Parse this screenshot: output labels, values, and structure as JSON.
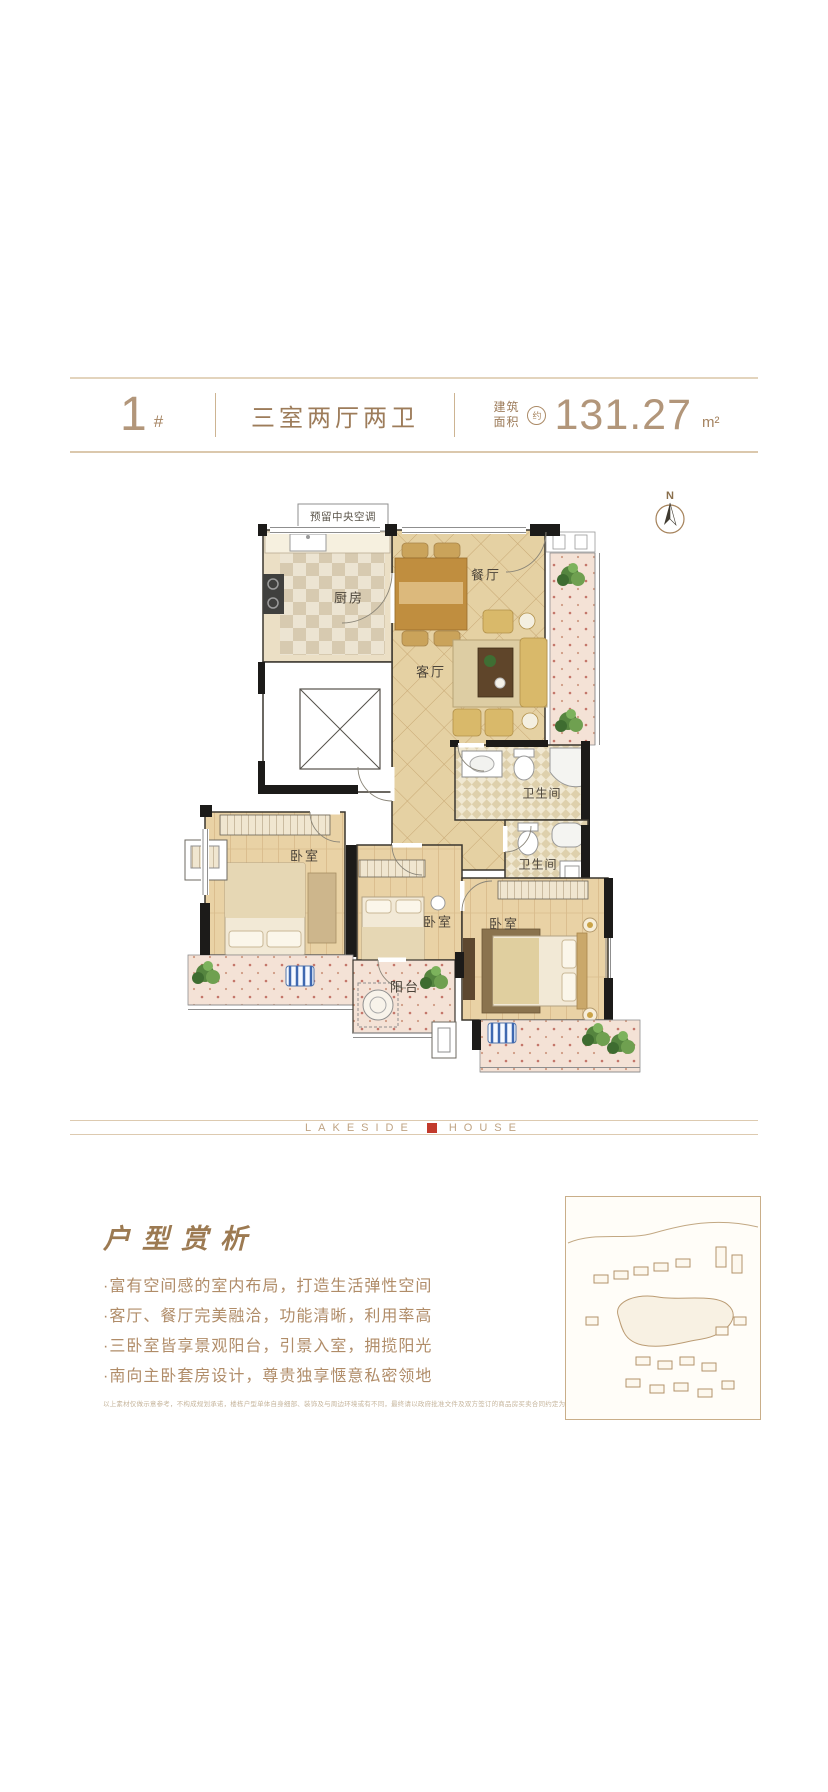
{
  "header": {
    "building_number": "1",
    "building_suffix": "#",
    "layout_type": "三室两厅两卫",
    "area_label_top": "建筑",
    "area_label_bottom": "面积",
    "area_prefix": "约",
    "area_value": "131.27",
    "area_unit": "m²"
  },
  "floor_plan": {
    "ac_note": "预留中央空调",
    "compass": "N",
    "labels": {
      "kitchen": "厨房",
      "dining": "餐厅",
      "living": "客厅",
      "bathroom_1": "卫生间",
      "bathroom_2": "卫生间",
      "bedroom_left": "卧室",
      "bedroom_middle": "卧室",
      "bedroom_master": "卧室",
      "balcony": "阳台"
    }
  },
  "brand": {
    "name_left": "LAKESIDE",
    "name_right": "HOUSE"
  },
  "analysis": {
    "title": "户型赏析",
    "bullets": [
      "·富有空间感的室内布局，打造生活弹性空间",
      "·客厅、餐厅完美融洽，功能清晰，利用率高",
      "·三卧室皆享景观阳台，引景入室，拥揽阳光",
      "·南向主卧套房设计，尊贵独享惬意私密领地"
    ],
    "disclaimer": "以上素材仅做示意参考，不构成规划承诺，楼栋户型单体自身细部、装饰及与周边环境或有不同，最终请以政府批准文件及双方签订的商品房买卖合同约定为准。"
  },
  "colors": {
    "accent_brown": "#a98a66",
    "line_tan": "#ddcab0",
    "seal_red": "#c23a2c"
  }
}
